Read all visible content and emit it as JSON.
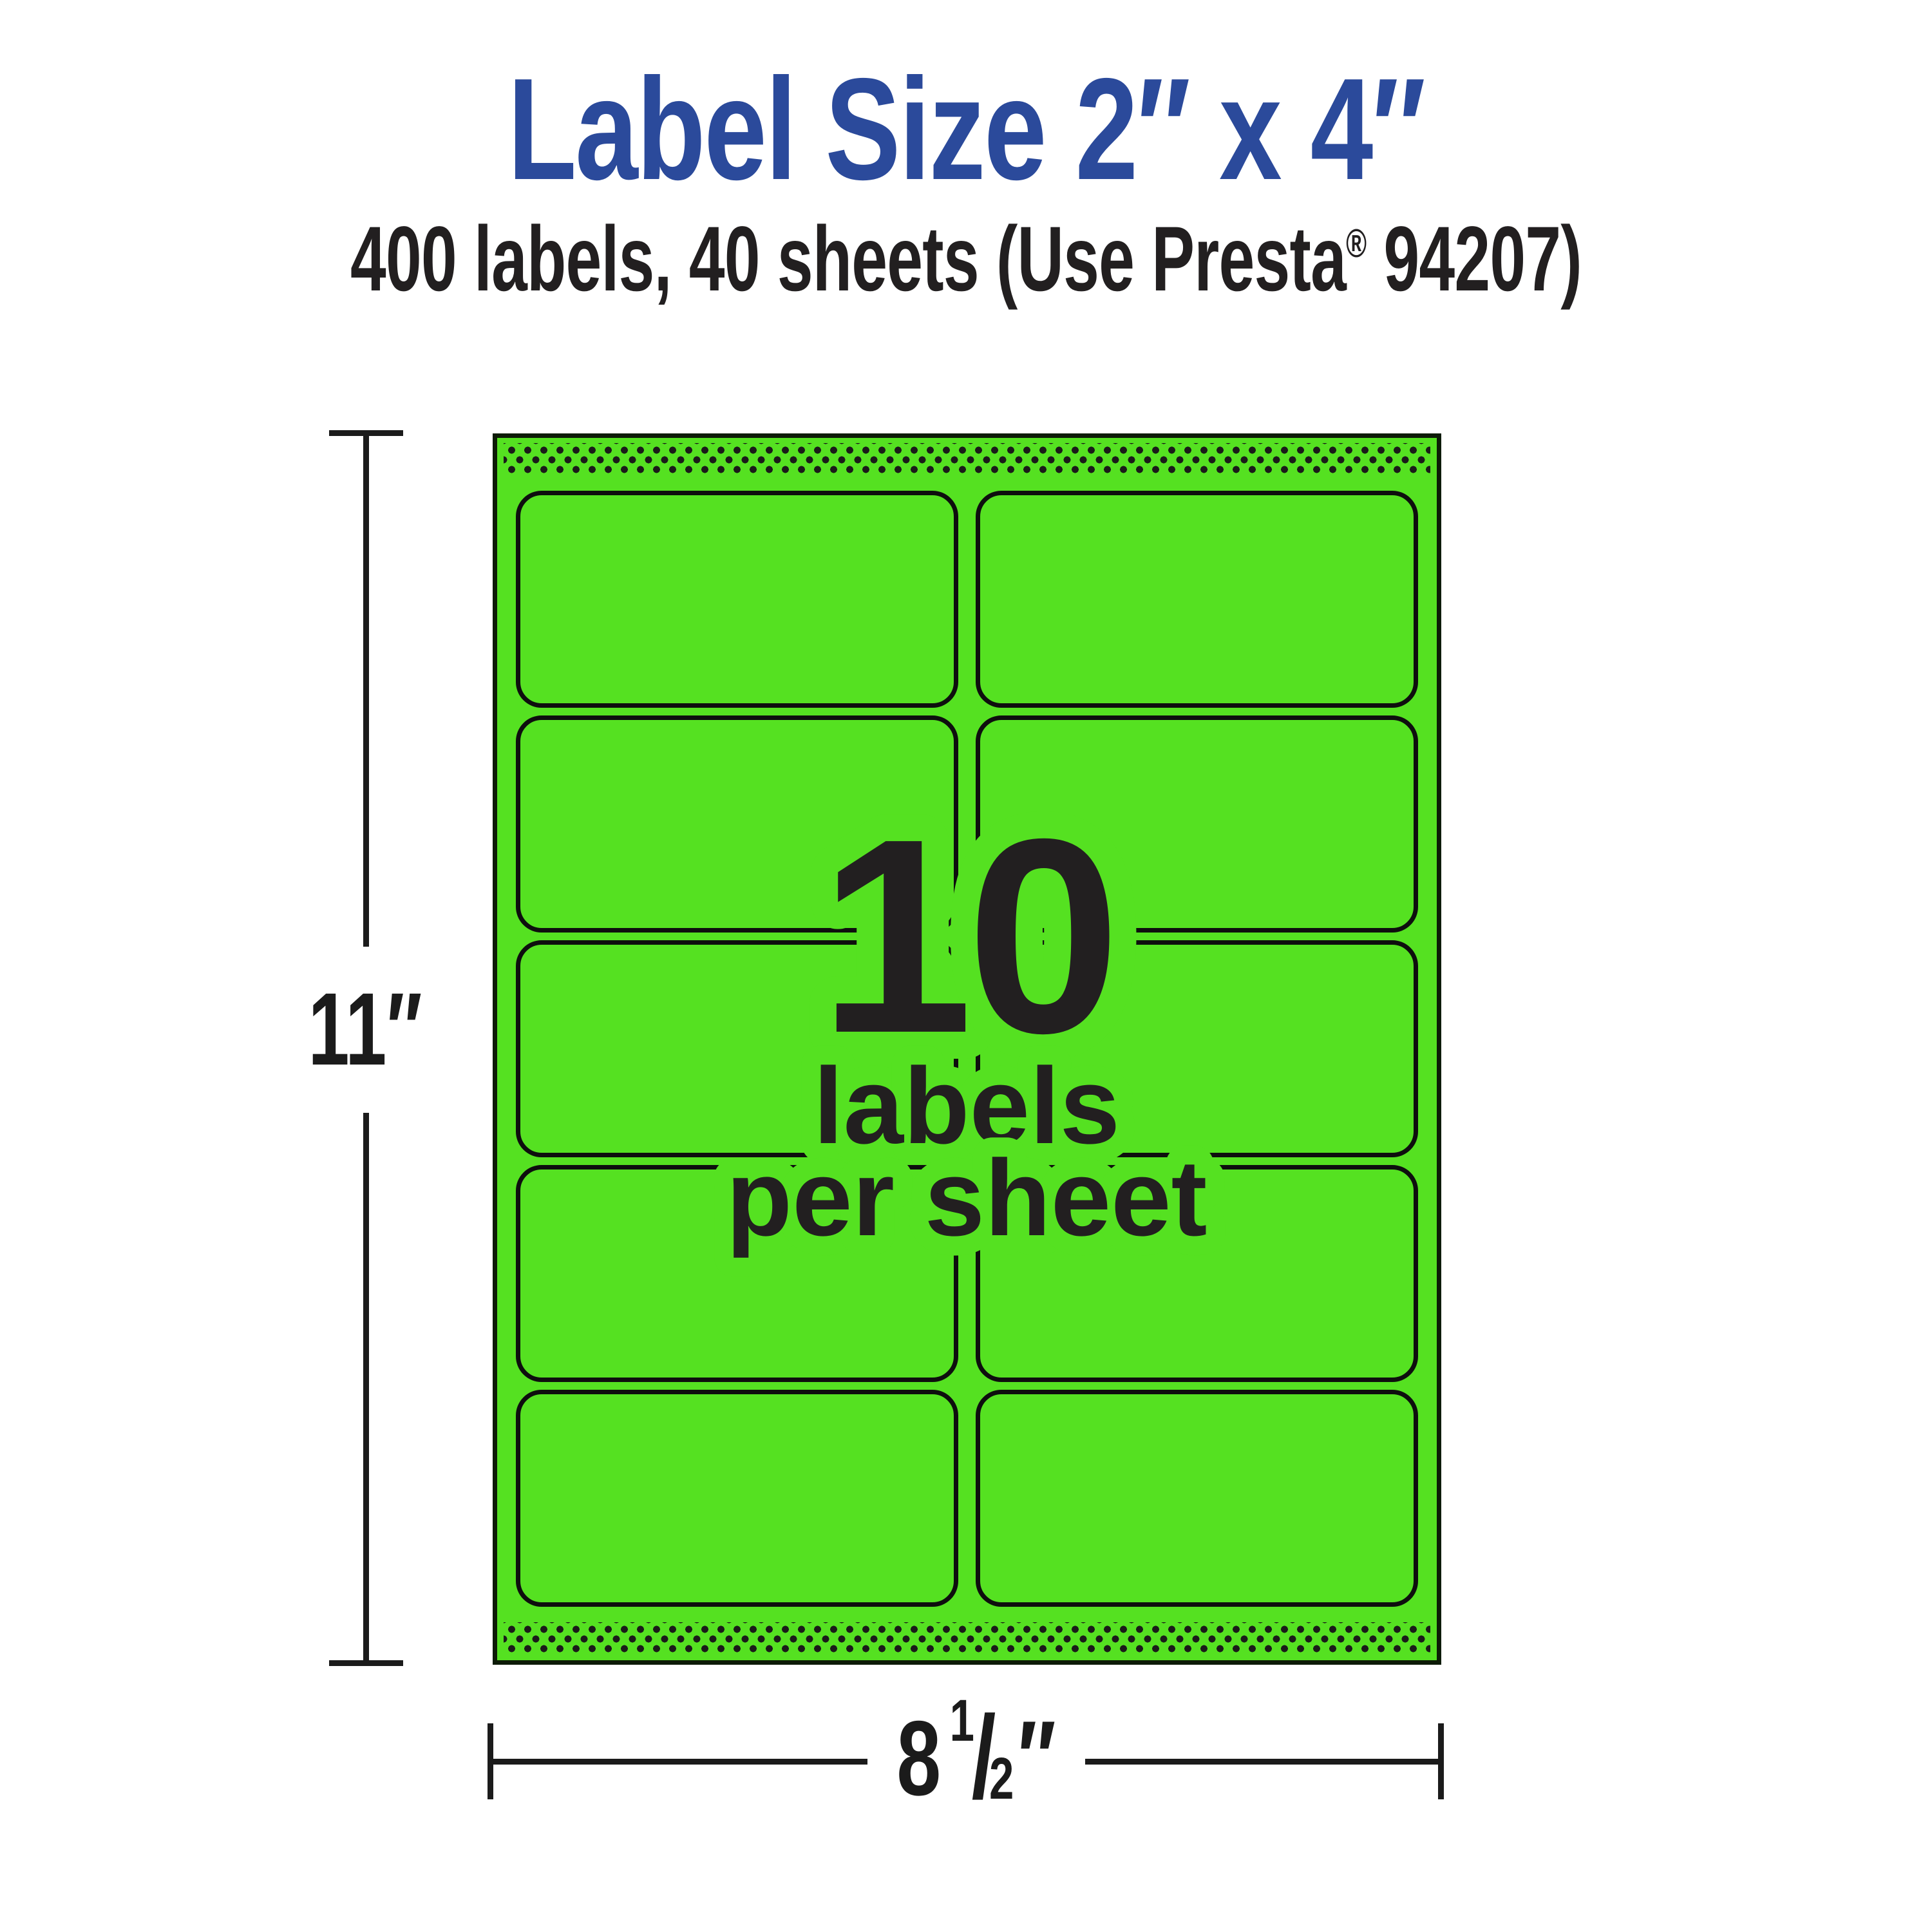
{
  "title": "Label Size 2″ x 4″",
  "subtitle": {
    "part1": "400 labels, 40 sheets (Use Presta",
    "registered": "®",
    "part2": " 94207)"
  },
  "sheet": {
    "count": "10",
    "line1": "labels",
    "line2": "per sheet",
    "grid": {
      "columns": 2,
      "rows": 5
    }
  },
  "dimensions": {
    "height": {
      "label": "11″"
    },
    "width": {
      "whole": "8",
      "numerator": "1",
      "slash": "/",
      "denominator": "2",
      "unit": "″"
    }
  },
  "colors": {
    "green": "#55E121",
    "blue": "#2B4A9B",
    "ink": "#221F20",
    "line": "#0E0E0E",
    "sheetline": "#0D1B07",
    "dot": "#1B1B19",
    "dim": "#1B1B1B"
  }
}
